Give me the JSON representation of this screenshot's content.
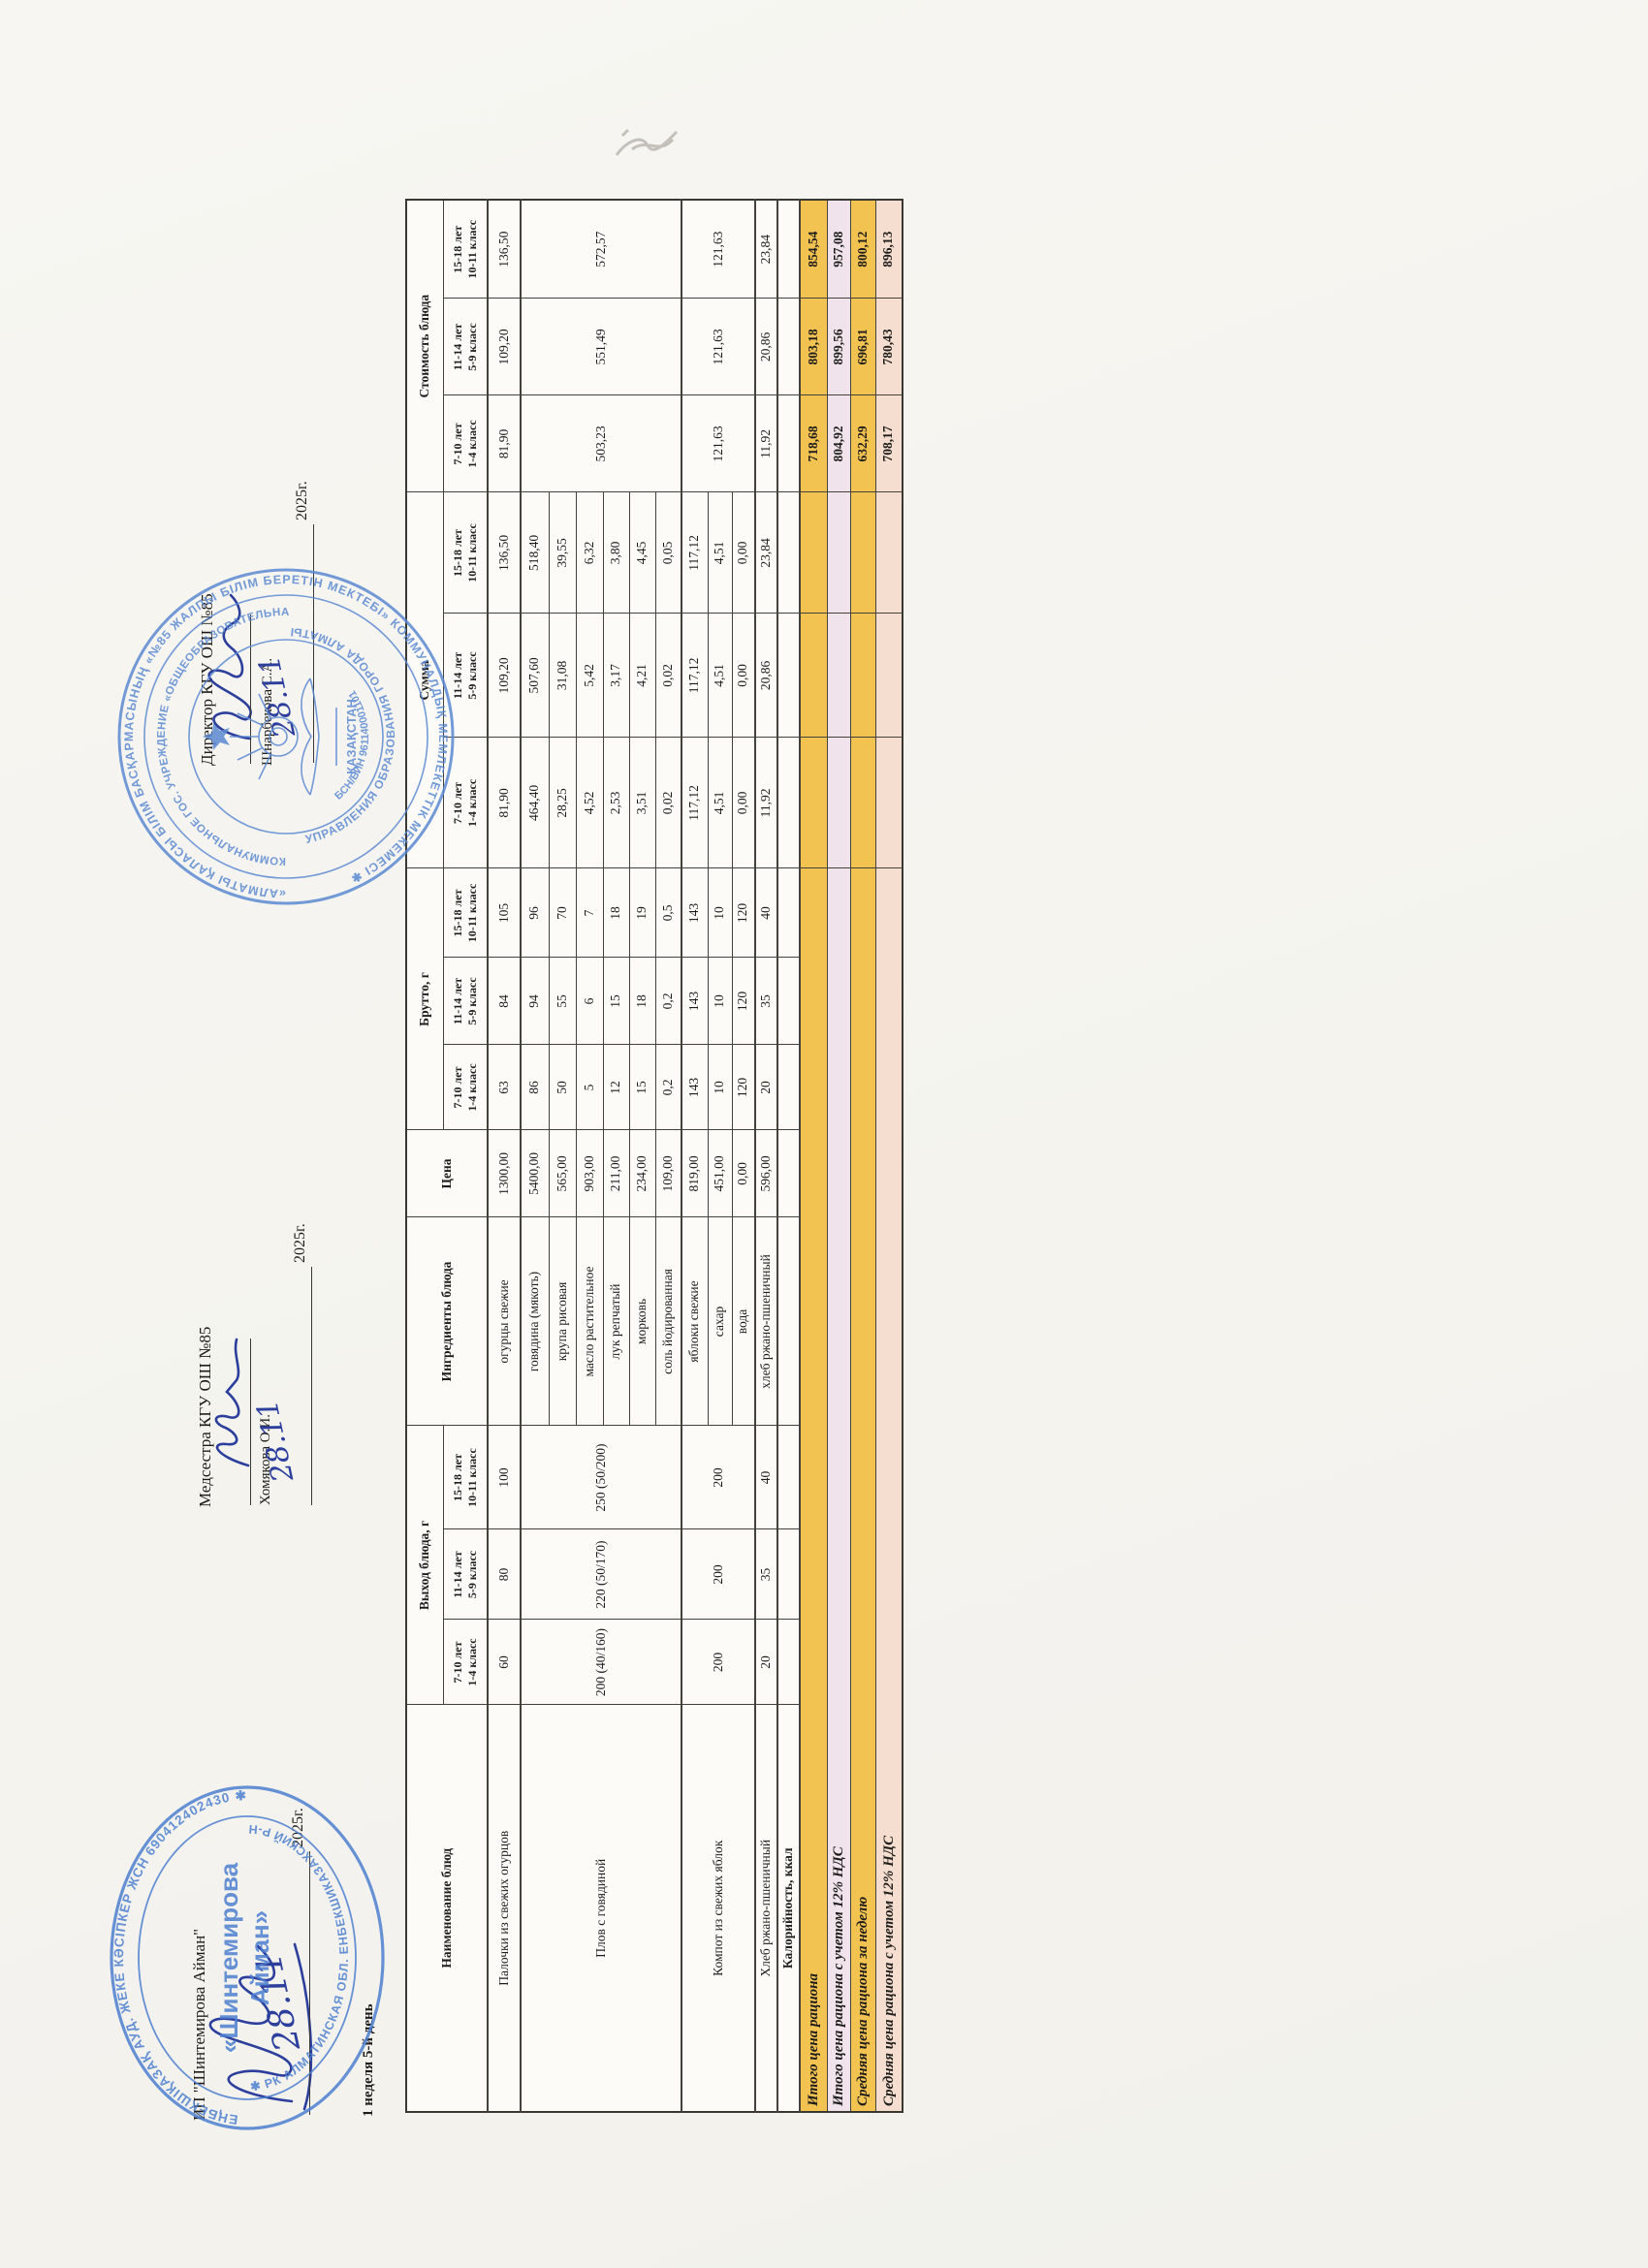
{
  "document": {
    "day_label": "1 неделя 5-й день",
    "year_suffix": "2025г.",
    "signature_blocks": {
      "ip": {
        "title": "ИП \"Шинтемирова Айман\"",
        "handwritten_date": "28.11",
        "year": "2025г."
      },
      "nurse": {
        "title": "Медсестра КГУ ОШ №85",
        "name": "Хомякова О.И.",
        "handwritten_date": "28.11",
        "year": "2025г."
      },
      "director": {
        "title": "Директор КГУ ОШ №85",
        "name": "Шнарбекова С.А.",
        "handwritten_date": "28.11",
        "year": "2025г."
      }
    },
    "stamps": {
      "oval": {
        "ring_top": "ЕҢБЕКШІҚАЗАҚ АУД. ЖЕКЕ КӘСІПКЕР ЖСН 690412402430 ✱ ҚАЗАҚСТАН РЕСПУБЛИКАСЫ АЛМАТЫ ОБЛ.",
        "ring_bottom": "✱ РК АЛМАТИНСКАЯ ОБЛ. ЕНБЕКШИКАЗАХСКИЙ Р-Н ИНДИВ. ПРЕДПРИНИМАТЕЛЬ ИИН 690412402430",
        "center_line1": "«Шинтемирова",
        "center_line2": "Айман»"
      },
      "round": {
        "ring_outer": "«АЛМАТЫ ҚАЛАСЫ БІЛІМ БАСҚАРМАСЫНЫҢ «№85 ЖАЛПЫ БІЛІМ БЕРЕТІН МЕКТЕБІ» КОММУНАЛДЫҚ МЕМЛЕКЕТТІК МЕКЕМЕСІ ✱",
        "ring_inner_top": "КОММУНАЛЬНОЕ ГОС. УЧРЕЖДЕНИЕ «ОБЩЕОБРАЗОВАТЕЛЬНАЯ ШКОЛА №85»",
        "ring_inner_bottom": "УПРАВЛЕНИЯ ОБРАЗОВАНИЯ ГОРОДА АЛМАТЫ",
        "bin": "БСН/БИН 961140001101",
        "center_banner": "ҚАЗАҚСТАН"
      }
    }
  },
  "table": {
    "headers": {
      "name": "Наименование блюд",
      "out": "Выход блюда, г",
      "ing": "Ингредиенты блюда",
      "price": "Цена",
      "gross": "Брутто, г",
      "sum": "Сумма",
      "cost": "Стоимость блюда"
    },
    "age": [
      {
        "l1": "7-10 лет",
        "l2": "1-4 класс"
      },
      {
        "l1": "11-14 лет",
        "l2": "5-9 класс"
      },
      {
        "l1": "15-18 лет",
        "l2": "10-11 класс"
      }
    ],
    "rows": [
      {
        "dish": "Палочки из свежих огурцов",
        "out1": "60",
        "out2": "80",
        "out3": "100",
        "ing": "огурцы свежие",
        "price": "1300,00",
        "b1": "63",
        "b2": "84",
        "b3": "105",
        "s1": "81,90",
        "s2": "109,20",
        "s3": "136,50",
        "c1": "81,90",
        "c2": "109,20",
        "c3": "136,50"
      },
      {
        "dish": "Плов с говядиной",
        "out1": "200 (40/160)",
        "out2": "220 (50/170)",
        "out3": "250 (50/200)",
        "c1": "503,23",
        "c2": "551,49",
        "c3": "572,57",
        "ings": [
          {
            "ing": "говядина (мякоть)",
            "price": "5400,00",
            "b1": "86",
            "b2": "94",
            "b3": "96",
            "s1": "464,40",
            "s2": "507,60",
            "s3": "518,40"
          },
          {
            "ing": "крупа рисовая",
            "price": "565,00",
            "b1": "50",
            "b2": "55",
            "b3": "70",
            "s1": "28,25",
            "s2": "31,08",
            "s3": "39,55"
          },
          {
            "ing": "масло растительное",
            "price": "903,00",
            "b1": "5",
            "b2": "6",
            "b3": "7",
            "s1": "4,52",
            "s2": "5,42",
            "s3": "6,32"
          },
          {
            "ing": "лук репчатый",
            "price": "211,00",
            "b1": "12",
            "b2": "15",
            "b3": "18",
            "s1": "2,53",
            "s2": "3,17",
            "s3": "3,80"
          },
          {
            "ing": "морковь",
            "price": "234,00",
            "b1": "15",
            "b2": "18",
            "b3": "19",
            "s1": "3,51",
            "s2": "4,21",
            "s3": "4,45"
          },
          {
            "ing": "соль йодированная",
            "price": "109,00",
            "b1": "0,2",
            "b2": "0,2",
            "b3": "0,5",
            "s1": "0,02",
            "s2": "0,02",
            "s3": "0,05"
          }
        ]
      },
      {
        "dish": "Компот из свежих яблок",
        "out1": "200",
        "out2": "200",
        "out3": "200",
        "c1": "121,63",
        "c2": "121,63",
        "c3": "121,63",
        "ings": [
          {
            "ing": "яблоки свежие",
            "price": "819,00",
            "b1": "143",
            "b2": "143",
            "b3": "143",
            "s1": "117,12",
            "s2": "117,12",
            "s3": "117,12"
          },
          {
            "ing": "сахар",
            "price": "451,00",
            "b1": "10",
            "b2": "10",
            "b3": "10",
            "s1": "4,51",
            "s2": "4,51",
            "s3": "4,51"
          },
          {
            "ing": "вода",
            "price": "0,00",
            "b1": "120",
            "b2": "120",
            "b3": "120",
            "s1": "0,00",
            "s2": "0,00",
            "s3": "0,00"
          }
        ]
      },
      {
        "dish": "Хлеб ржано-пшеничный",
        "out1": "20",
        "out2": "35",
        "out3": "40",
        "ing": "хлеб ржано-пшеничный",
        "price": "596,00",
        "b1": "20",
        "b2": "35",
        "b3": "40",
        "s1": "11,92",
        "s2": "20,86",
        "s3": "23,84",
        "c1": "11,92",
        "c2": "20,86",
        "c3": "23,84"
      },
      {
        "dish": "Калорийность, ккал"
      }
    ],
    "totals": [
      {
        "label": "Итого цена рациона",
        "c1": "718,68",
        "c2": "803,18",
        "c3": "854,54"
      },
      {
        "label": "Итого цена рациона с учетом 12% НДС",
        "c1": "804,92",
        "c2": "899,56",
        "c3": "957,08"
      },
      {
        "label": "Средняя цена рациона за неделю",
        "c1": "632,29",
        "c2": "696,81",
        "c3": "800,12"
      },
      {
        "label": "Средняя цена рациона с учетом 12% НДС",
        "c1": "708,17",
        "c2": "780,43",
        "c3": "896,13"
      }
    ]
  }
}
